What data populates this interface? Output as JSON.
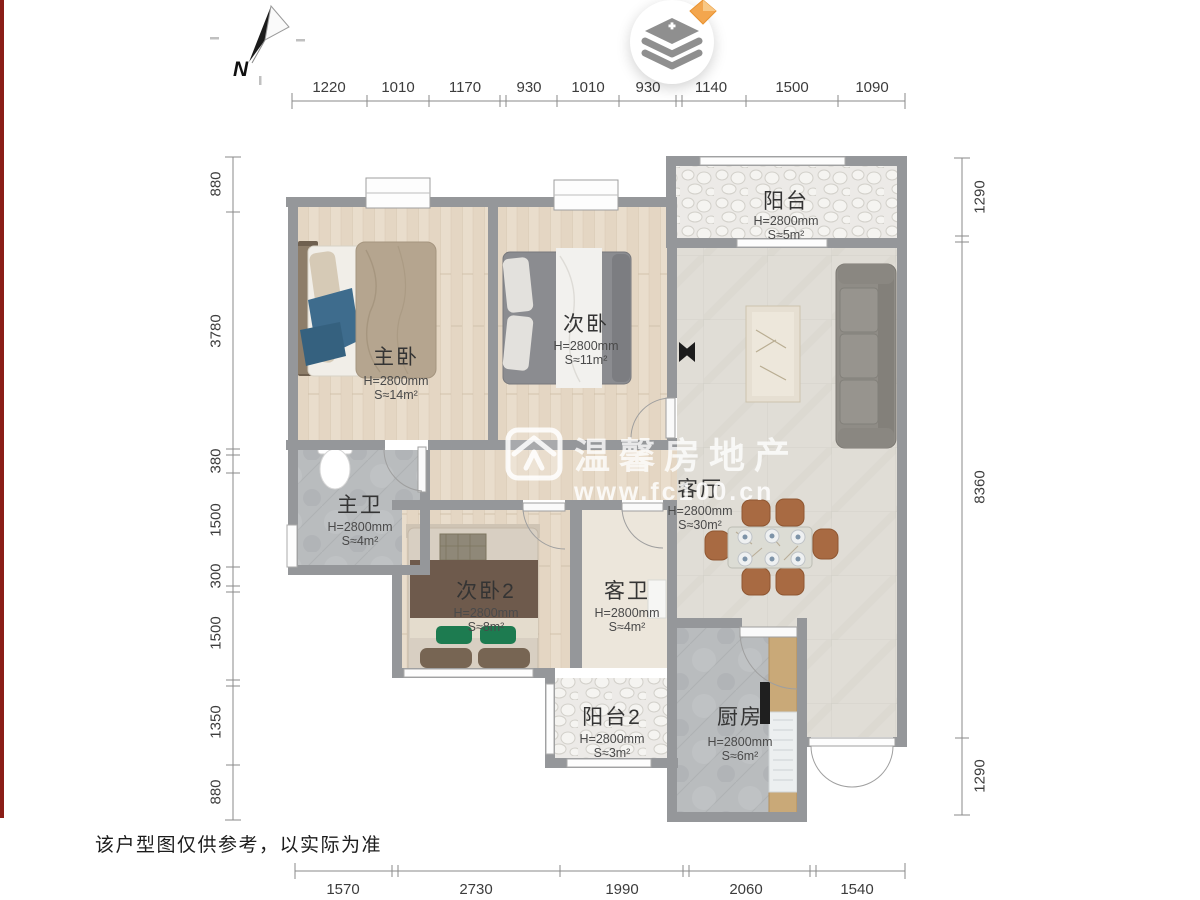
{
  "meta": {
    "compass_label": "N",
    "disclaimer": "该户型图仅供参考，以实际为准",
    "watermark": {
      "line1": "温馨房地产",
      "line2": "www.fc100.cn"
    },
    "layers_button": {
      "icon": "layers-plus-icon",
      "badge": "orange-diamond"
    }
  },
  "colors": {
    "wall": "#95979a",
    "wood_floor": "#e9ddcc",
    "tile_gray": "#b9bcbe",
    "living_floor": "#e0ddd6",
    "pebble_floor": "#eceae7",
    "accent_red_strip": "#8a1d17",
    "badge_orange": "#f3a64e",
    "green_pillow": "#1d7b50",
    "chair_brown": "#a86a42"
  },
  "dimensions": {
    "top": [
      "1220",
      "1010",
      "1170",
      "930",
      "1010",
      "930",
      "1140",
      "1500",
      "1090"
    ],
    "left": [
      "880",
      "3780",
      "380",
      "1500",
      "300",
      "1500",
      "1350",
      "880"
    ],
    "right": [
      "1290",
      "8360",
      "1290"
    ],
    "bottom": [
      "1570",
      "2730",
      "1990",
      "2060",
      "1540"
    ]
  },
  "rooms": [
    {
      "name": "阳台",
      "height": "H=2800mm",
      "area": "S≈5m²"
    },
    {
      "name": "主卧",
      "height": "H=2800mm",
      "area": "S≈14m²"
    },
    {
      "name": "次卧",
      "height": "H=2800mm",
      "area": "S≈11m²"
    },
    {
      "name": "主卫",
      "height": "H=2800mm",
      "area": "S≈4m²"
    },
    {
      "name": "次卧2",
      "height": "H=2800mm",
      "area": "S≈8m²"
    },
    {
      "name": "客卫",
      "height": "H=2800mm",
      "area": "S≈4m²"
    },
    {
      "name": "客厅",
      "height": "H=2800mm",
      "area": "S≈30m²"
    },
    {
      "name": "阳台2",
      "height": "H=2800mm",
      "area": "S≈3m²"
    },
    {
      "name": "厨房",
      "height": "H=2800mm",
      "area": "S≈6m²"
    }
  ]
}
